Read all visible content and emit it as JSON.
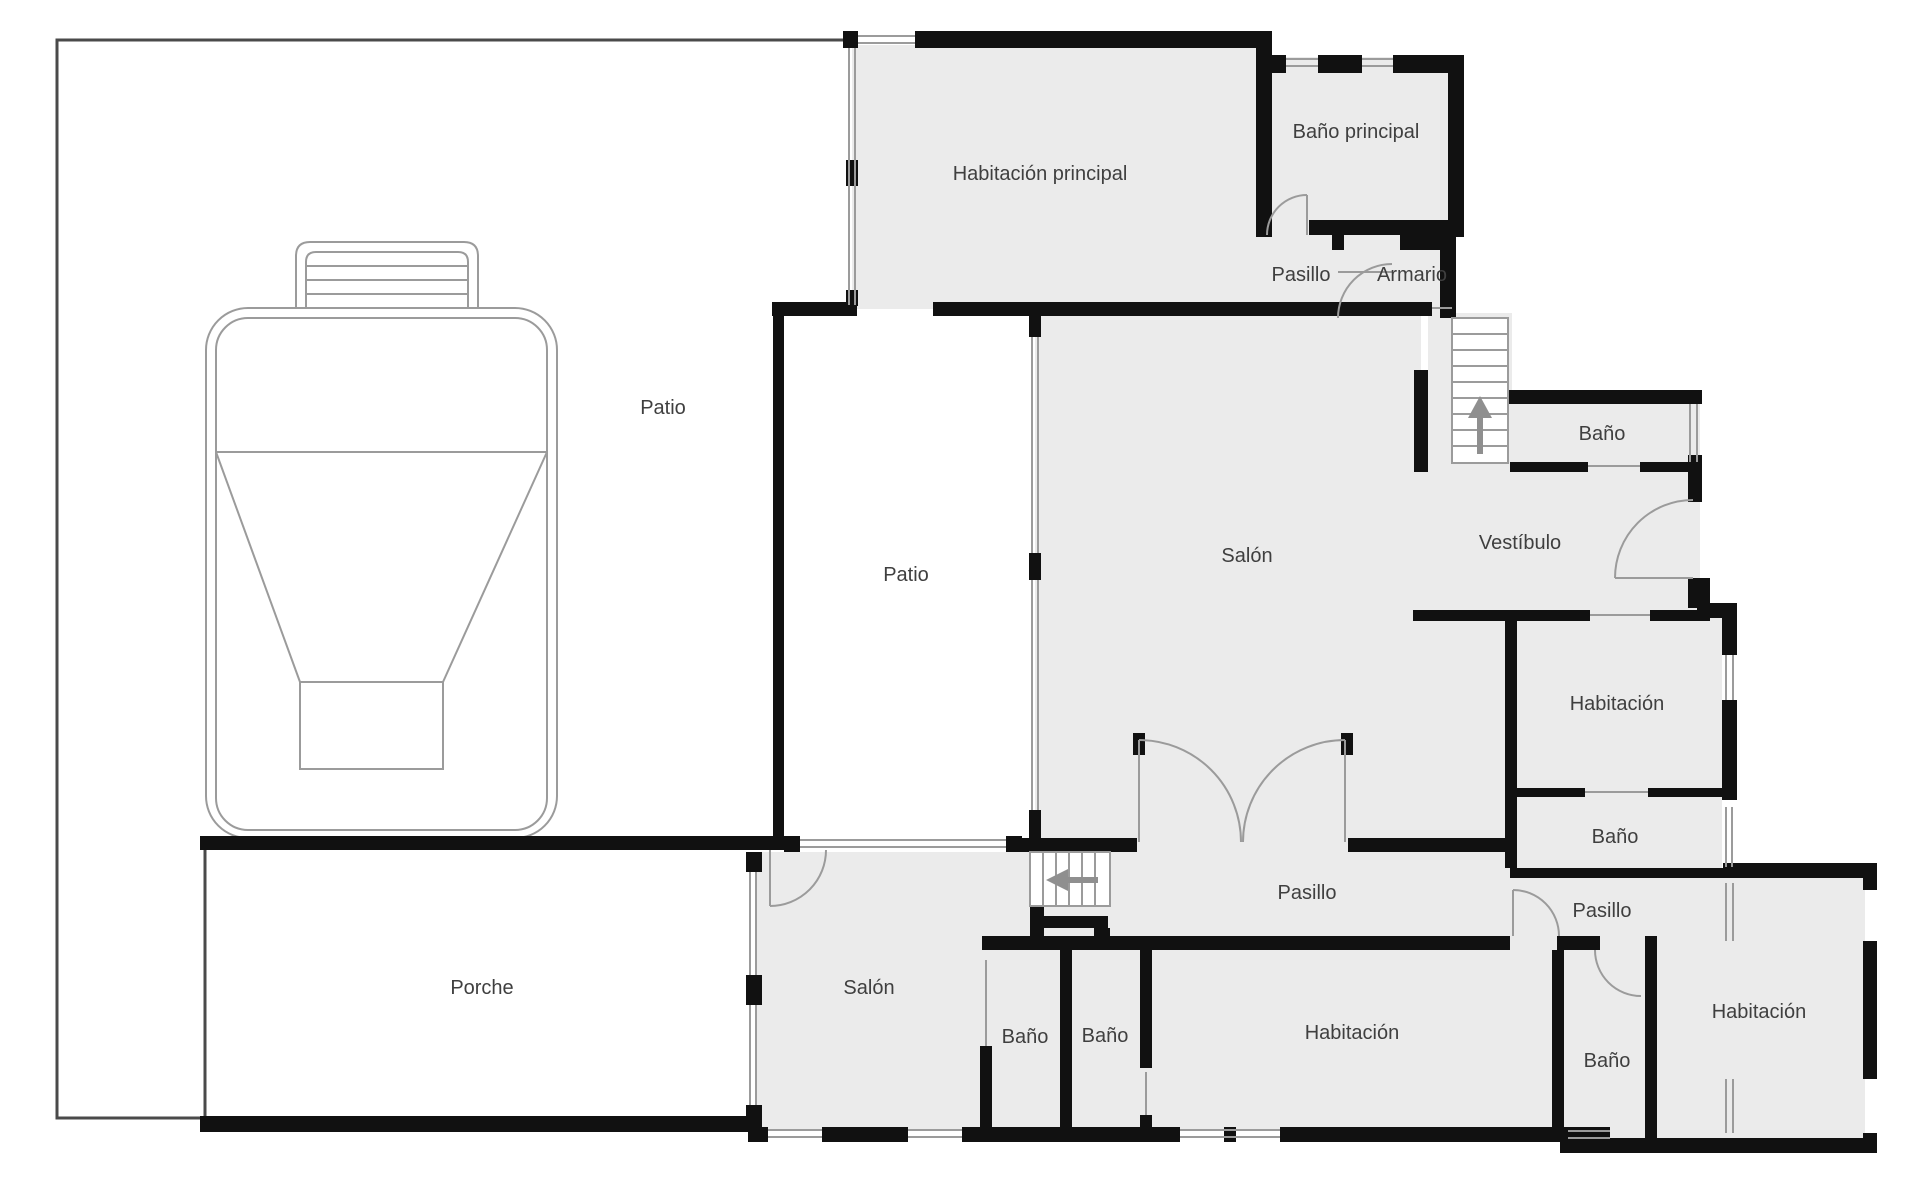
{
  "plan": {
    "canvas": {
      "width": 1920,
      "height": 1182
    },
    "colors": {
      "background": "#ffffff",
      "wall": "#111111",
      "room_fill": "#ebebeb",
      "thin_line": "#9b9b9b",
      "boundary": "#4a4a4a",
      "label": "#3f3f3f",
      "arrow": "#8f8f8f"
    },
    "labels": [
      {
        "id": "habitacion-principal",
        "label": "Habitación principal",
        "x": 1040,
        "y": 180
      },
      {
        "id": "bano-principal",
        "label": "Baño principal",
        "x": 1356,
        "y": 138
      },
      {
        "id": "pasillo-top",
        "label": "Pasillo",
        "x": 1301,
        "y": 281
      },
      {
        "id": "armario",
        "label": "Armario",
        "x": 1412,
        "y": 281
      },
      {
        "id": "patio-left",
        "label": "Patio",
        "x": 663,
        "y": 414
      },
      {
        "id": "patio-center",
        "label": "Patio",
        "x": 906,
        "y": 581
      },
      {
        "id": "salon-center",
        "label": "Salón",
        "x": 1247,
        "y": 562
      },
      {
        "id": "vestibulo",
        "label": "Vestíbulo",
        "x": 1520,
        "y": 549
      },
      {
        "id": "bano-top-right",
        "label": "Baño",
        "x": 1602,
        "y": 440
      },
      {
        "id": "habitacion-right",
        "label": "Habitación",
        "x": 1617,
        "y": 710
      },
      {
        "id": "bano-right",
        "label": "Baño",
        "x": 1615,
        "y": 843
      },
      {
        "id": "pasillo-center",
        "label": "Pasillo",
        "x": 1307,
        "y": 899
      },
      {
        "id": "pasillo-right",
        "label": "Pasillo",
        "x": 1602,
        "y": 917
      },
      {
        "id": "porche",
        "label": "Porche",
        "x": 482,
        "y": 994
      },
      {
        "id": "salon-bottom",
        "label": "Salón",
        "x": 869,
        "y": 994
      },
      {
        "id": "bano-bottom-1",
        "label": "Baño",
        "x": 1025,
        "y": 1043
      },
      {
        "id": "bano-bottom-2",
        "label": "Baño",
        "x": 1105,
        "y": 1042
      },
      {
        "id": "habitacion-bottom",
        "label": "Habitación",
        "x": 1352,
        "y": 1039
      },
      {
        "id": "bano-bottom-right",
        "label": "Baño",
        "x": 1607,
        "y": 1067
      },
      {
        "id": "habitacion-bottom-right",
        "label": "Habitación",
        "x": 1759,
        "y": 1018
      }
    ],
    "stairs": [
      {
        "id": "stairs-upper",
        "arrow": "up"
      },
      {
        "id": "stairs-lower",
        "arrow": "left"
      }
    ]
  }
}
